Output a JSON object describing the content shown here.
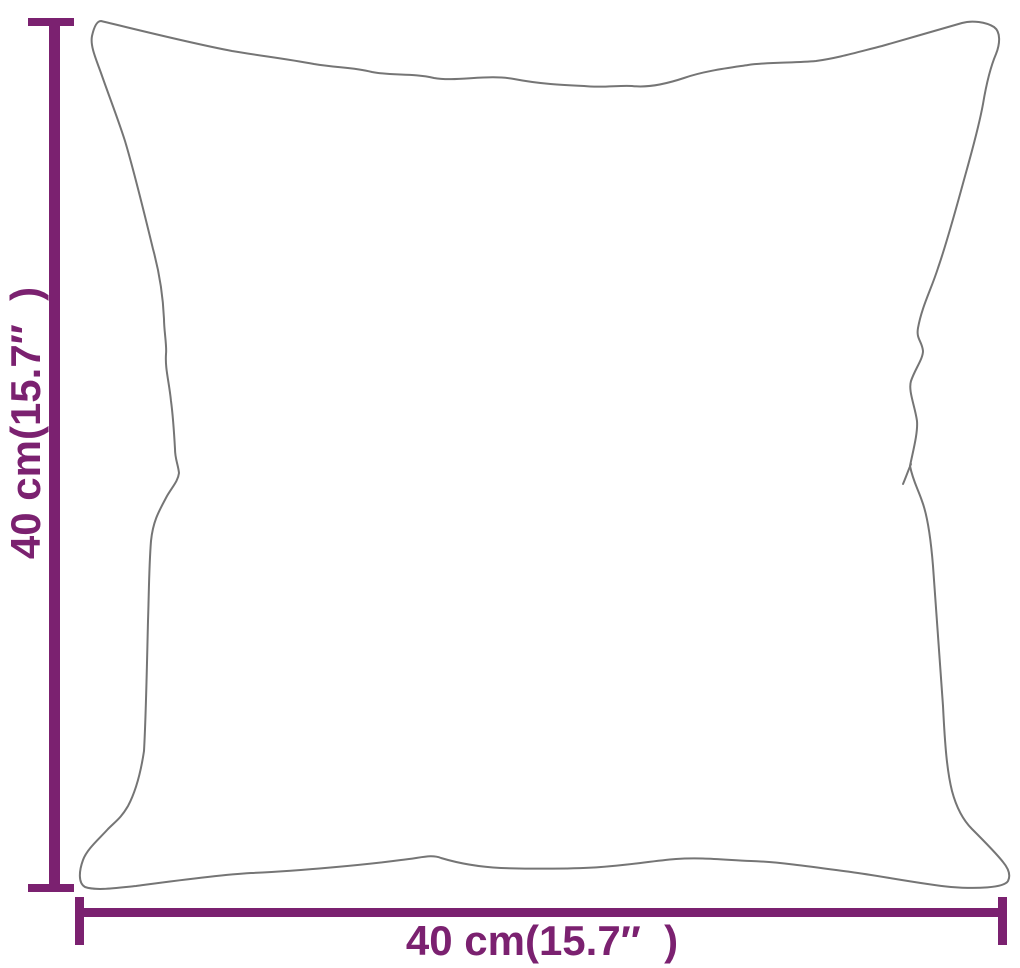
{
  "diagram": {
    "subject": "pillow-outline",
    "height_dimension": {
      "label": "40 cm(15.7″  )",
      "value_cm": 40,
      "value_inch": 15.7
    },
    "width_dimension": {
      "label": "40 cm(15.7″  )",
      "value_cm": 40,
      "value_inch": 15.7
    }
  },
  "colors": {
    "dimension_accent": "#7B2170",
    "pillow_outline": "#757575",
    "background": "#FFFFFF"
  }
}
